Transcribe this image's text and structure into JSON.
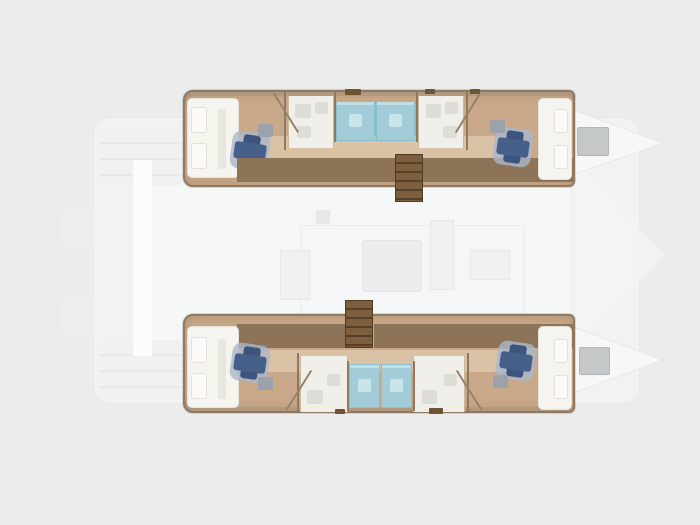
{
  "meta": {
    "title": "Catamaran yacht floor plan",
    "view": "top-down layout diagram",
    "bow_direction": "right",
    "highlighted_level": "hull accommodations",
    "faded_level": "main deck silhouette"
  },
  "palette": {
    "bg": "#ebecec",
    "deck": "#f1f2f2",
    "deck_line": "#e8e9e9",
    "deck_white": "#f6f7f7",
    "hull_floor": "#c9a98a",
    "hull_floor_light": "#d9c2a5",
    "hull_wall": "#8f7963",
    "wardrobe_divider": "#8d7357",
    "shower": "#a2cdd8",
    "shower_border": "#8abfcd",
    "shower_inner": "#c8e5e9",
    "fixture_panel": "#f1efea",
    "fixture_gray": "#deded8",
    "bed": "#f6f4ef",
    "bed_pillow": "#fbfaf8",
    "pillow_navy": "#3d557c",
    "pillow_navy2": "#46608a",
    "pillow_halo": "#aab6ca",
    "pillow_gray": "#9ba2ab",
    "stairs": "#6d5435",
    "stairs_dark": "#4f3c24",
    "step_platform": "#c5c8c8",
    "step_platform_border": "#b3b6b6"
  },
  "plan": {
    "wardrobe_tones": [
      "#e9dfd2",
      "#c6a98a",
      "#e3d4c0",
      "#cbab8c"
    ],
    "hulls": [
      {
        "name": "upper-hull",
        "cabins": [
          {
            "name": "aft-cabin",
            "bed": "double",
            "accent": "navy-pillows"
          },
          {
            "name": "fore-cabin",
            "bed": "double",
            "accent": "navy-pillows"
          }
        ],
        "shower_stalls": 2,
        "bathrooms": 2,
        "staircase": "inboard, right of midship",
        "extras": [
          "wardrobe-row",
          "bow-step-platform"
        ]
      },
      {
        "name": "lower-hull",
        "cabins": [
          {
            "name": "aft-cabin",
            "bed": "double",
            "accent": "navy-pillows"
          },
          {
            "name": "fore-cabin",
            "bed": "double",
            "accent": "navy-pillows"
          }
        ],
        "shower_stalls": 2,
        "bathrooms": 2,
        "staircase": "inboard, left of midship",
        "extras": [
          "wardrobe-row",
          "bow-step-platform"
        ]
      }
    ],
    "deck_elements": [
      "saloon-outline",
      "table",
      "mast-step",
      "side-deck",
      "transom-steps",
      "bow-points",
      "foredeck-wedge"
    ],
    "totals": {
      "cabins": 4,
      "beds": 4,
      "shower_stalls": 4,
      "staircases": 2
    }
  }
}
